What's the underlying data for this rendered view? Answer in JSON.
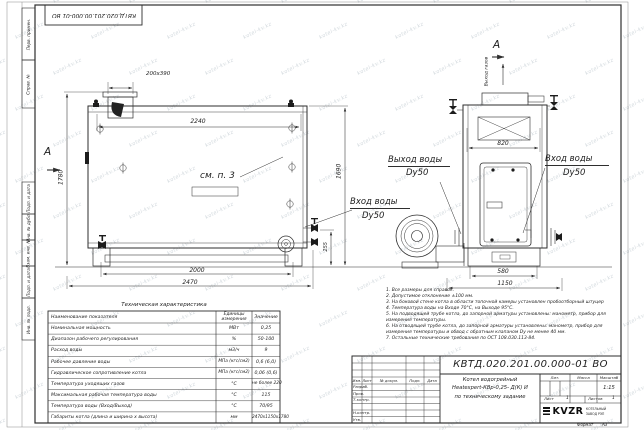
{
  "watermark": {
    "text": "kotel-kv.kz"
  },
  "sheet": {
    "stamp_top": "КВТД.020.201.00.000-01 ВО",
    "format_label": "Формат",
    "format_value": "А3",
    "margin_labels": [
      "Перв. примен.",
      "Справ. №",
      "Подп. и дата",
      "Инв. № дубл.",
      "Взам. инв. №",
      "Подп. и дата",
      "Инв. № подл."
    ]
  },
  "front_view": {
    "section": "А",
    "dim_flue": "200х390",
    "dim_top": "2240",
    "dim_height": "1780",
    "dim_right": "1690",
    "dim_inlet": "255",
    "dim_base": "2000",
    "dim_overall": "2470",
    "ref_note": "см. п. 3",
    "inlet": "Вход воды",
    "inlet_dn": "Dy50"
  },
  "side_view": {
    "section": "А",
    "gas_out": "Выход газов",
    "dim_width": "820",
    "dim_base": "580",
    "dim_overall": "1150",
    "outlet": "Выход воды",
    "outlet_dn": "Dy50",
    "inlet": "Вход воды",
    "inlet_dn": "Dy50"
  },
  "notes": {
    "lines": [
      "1. Все размеры для справок.",
      "2. Допустимое отклонение ±100 мм.",
      "3. На боковой стене котла в области топочной камеры установлен пробоотборный штуцер",
      "4. Температура воды на Входе 70°С, на Выходе 95°С.",
      "5. На подводящей трубе котла, до запорной арматуры установлены: манометр, прибор для измерения температуры.",
      "6. На отводящей трубе котла, до запорной арматуры установлены: манометр, прибор для измерения температуры и обвод с обратным клапаном Dу не менее 40 мм.",
      "7. Остальные технические требования по ОСТ 108.030.113-84."
    ]
  },
  "spec_table": {
    "title": "Техническая характеристика",
    "headers": [
      "Наименование показателя",
      "Единицы измерения",
      "Значение"
    ],
    "rows": [
      [
        "Номинальная мощность",
        "МВт",
        "0,25"
      ],
      [
        "Диапазон рабочего регулирования",
        "%",
        "50-100"
      ],
      [
        "Расход воды",
        "м3/ч",
        "9"
      ],
      [
        "Рабочее давление воды",
        "МПа (кгс/см2)",
        "0,6 (6,0)"
      ],
      [
        "Гидравлическое сопротивление котла",
        "МПа (кгс/см2)",
        "0,06 (0,6)"
      ],
      [
        "Температура уходящих газов",
        "°С",
        "не более 220"
      ],
      [
        "Максимальная рабочая температура воды",
        "°С",
        "115"
      ],
      [
        "Температура воды (Вход/Выход)",
        "°С",
        "70/95"
      ],
      [
        "Габариты котла (длина и ширина х высота)",
        "мм",
        "2470х1150х1780"
      ]
    ]
  },
  "title_block": {
    "doc_number": "КВТД.020.201.00.000-01 ВО",
    "name_lines": [
      "Котел водогрейный",
      "Heatexpert-КВр-0,25- Д(К) И",
      "по техническому задание"
    ],
    "cols": [
      "Изм.",
      "Лист",
      "№ докум.",
      "Подп.",
      "Дата"
    ],
    "rows": [
      "Разраб.",
      "Пров.",
      "Т.контр.",
      "Н.контр.",
      "Утв."
    ],
    "lit_label": "Лит.",
    "mass_label": "Масса",
    "scale_label": "Масштаб",
    "scale_value": "1:15",
    "sheet_label": "Лист",
    "sheet_value": "1",
    "sheets_label": "Листов",
    "sheets_value": "1",
    "logo_text": "KVZR",
    "logo_lines": [
      "КОТЕЛЬНЫЙ",
      "ЗАВОД РЭП"
    ]
  }
}
